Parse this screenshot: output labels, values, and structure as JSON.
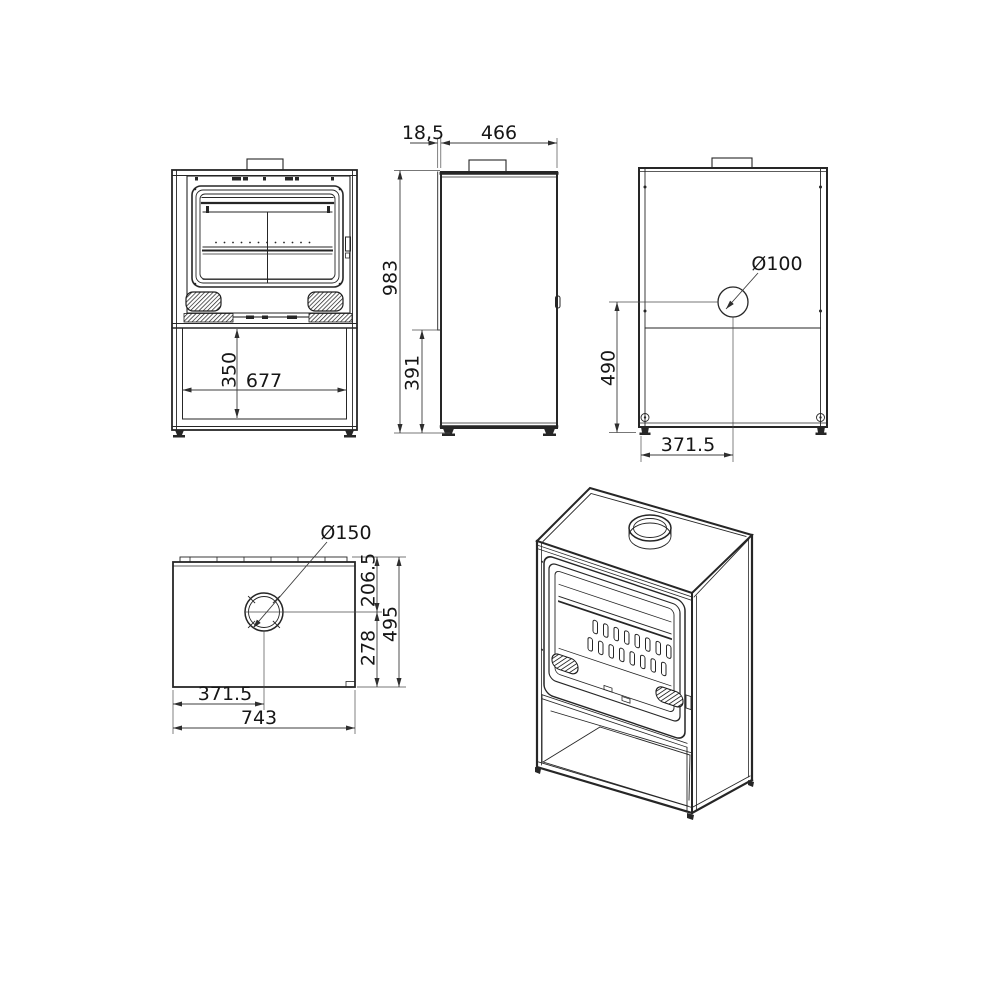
{
  "colors": {
    "line": "#262626",
    "dimension_line": "#3c3c3c",
    "text": "#161616",
    "background": "#ffffff"
  },
  "views": {
    "front": {
      "dims": {
        "base_opening_height": "350",
        "base_opening_width": "677"
      }
    },
    "side": {
      "dims": {
        "door_front_offset": "18,5",
        "body_depth": "466",
        "total_height": "983",
        "lower_front_height": "391"
      }
    },
    "back": {
      "dims": {
        "air_inlet_diameter": "Ø100",
        "air_inlet_center_height": "490",
        "air_inlet_center_from_side": "371.5"
      }
    },
    "top": {
      "dims": {
        "flue_diameter": "Ø150",
        "flue_center_to_back": "206.5",
        "flue_center_to_front": "278",
        "total_depth": "495",
        "flue_center_from_left": "371.5",
        "total_width": "743"
      }
    }
  }
}
